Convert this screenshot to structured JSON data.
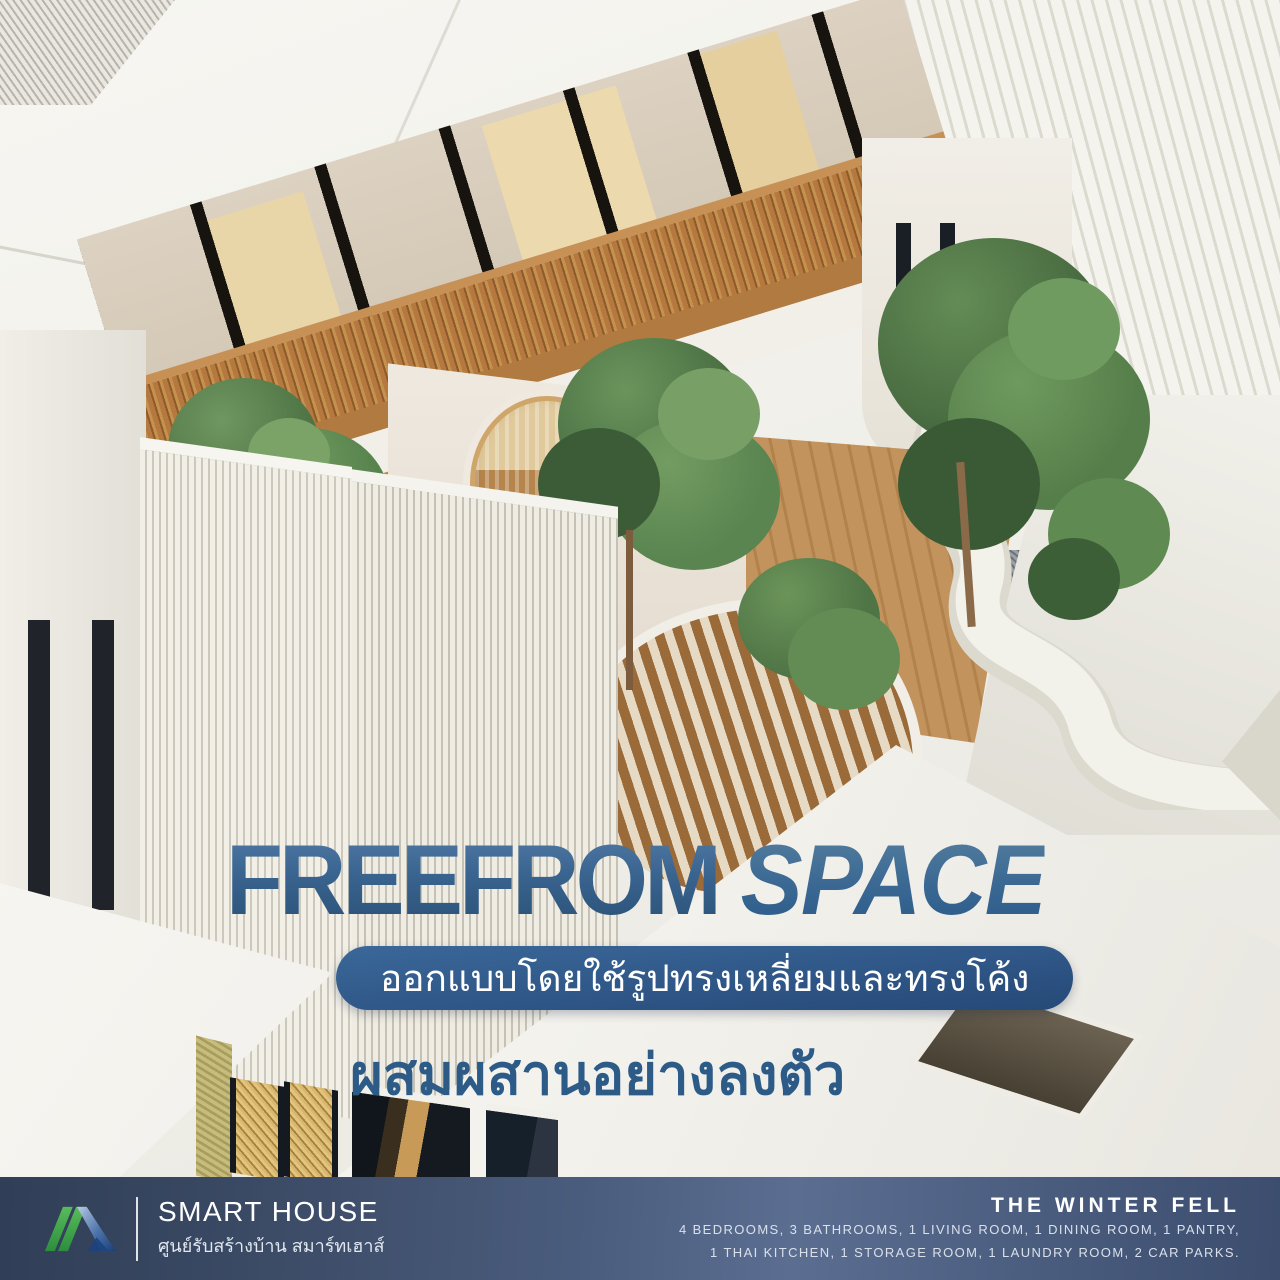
{
  "poster": {
    "title": {
      "word1": "FREEFROM",
      "word2": "SPACE"
    },
    "tagline_pill": "ออกแบบโดยใช้รูปทรงเหลี่ยมและทรงโค้ง",
    "tagline_emphasis": "ผสมผสานอย่างลงตัว"
  },
  "footer": {
    "brand": {
      "name": "SMART HOUSE",
      "subtitle": "ศูนย์รับสร้างบ้าน สมาร์ทเฮาส์"
    },
    "project": {
      "name": "THE WINTER FELL",
      "specs_line1": "4 BEDROOMS, 3 BATHROOMS, 1 LIVING ROOM, 1 DINING ROOM, 1 PANTRY,",
      "specs_line2": "1 THAI KITCHEN, 1 STORAGE ROOM, 1 LAUNDRY ROOM, 2 CAR PARKS."
    }
  },
  "icons": {
    "logo": "smart-house-roof-logo"
  },
  "colors": {
    "title_blue": "#3a6491",
    "pill_blue": "#2c5282",
    "emphasis_blue": "#2d5b88",
    "footer_navy": "#3c4d6e",
    "logo_green": "#3ba14a",
    "logo_blue": "#1c4480",
    "wood": "#b07a41",
    "foliage": "#4e7345"
  }
}
